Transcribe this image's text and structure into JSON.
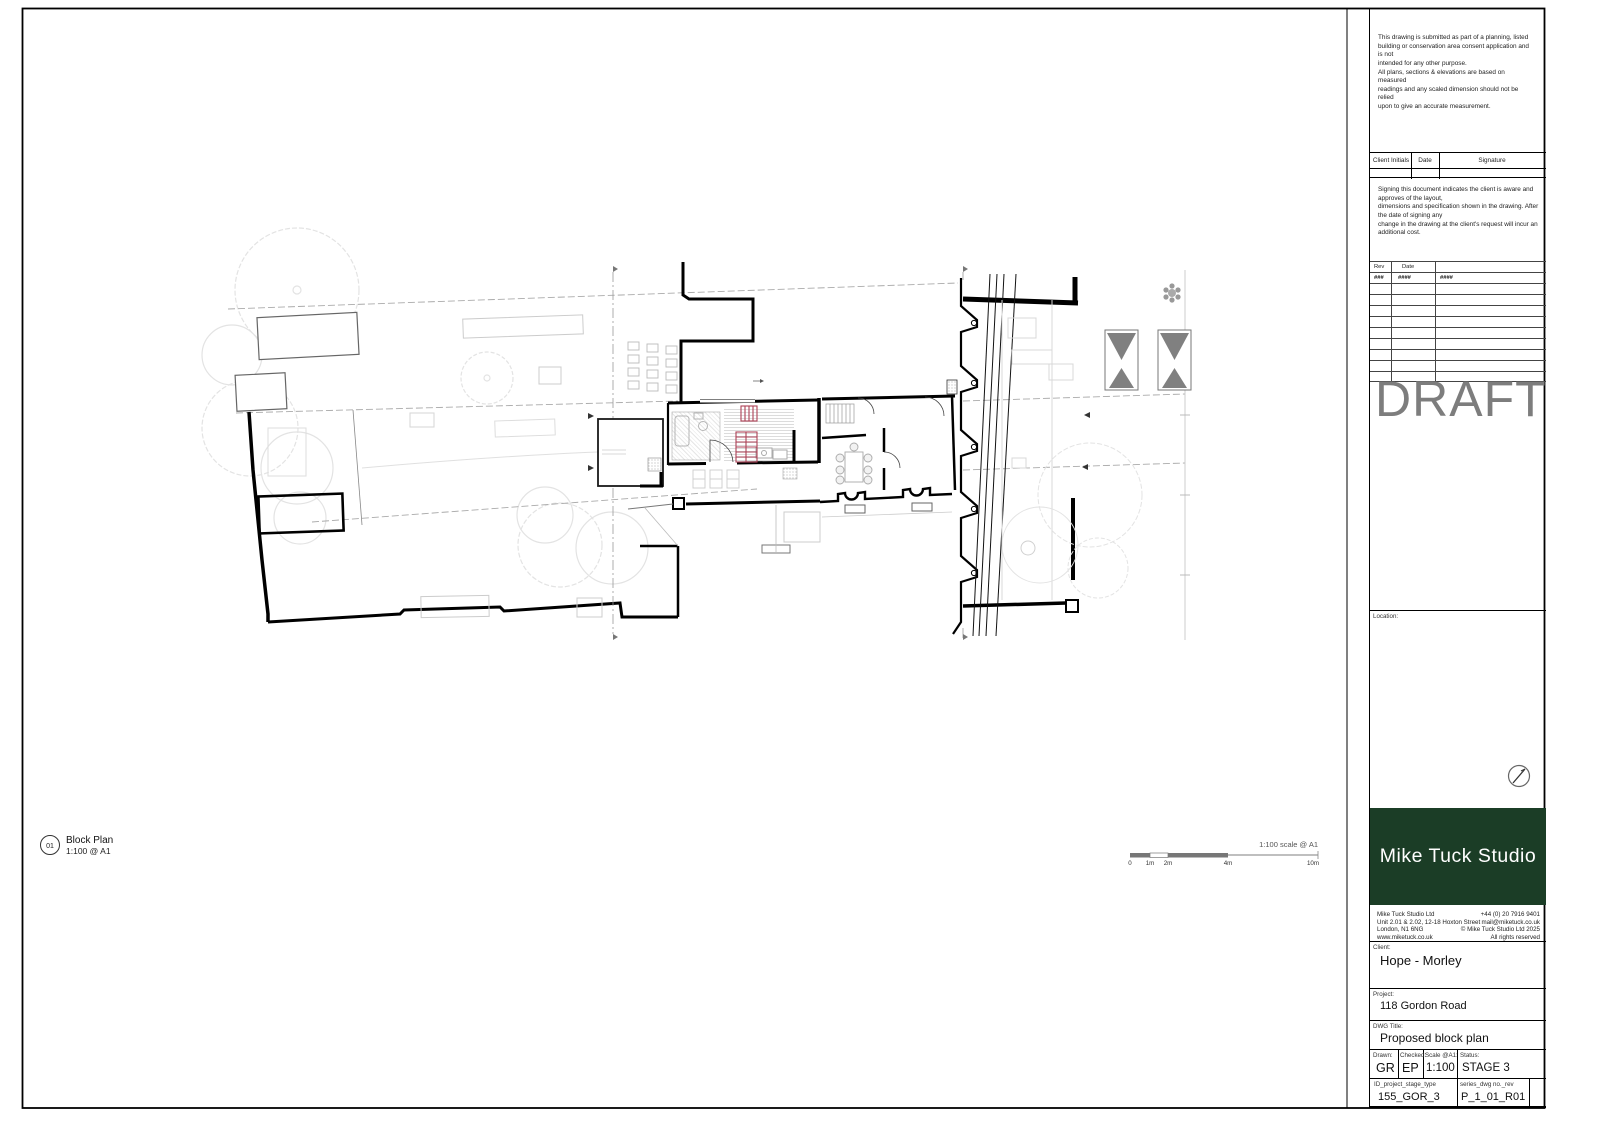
{
  "titleblock": {
    "disclaimer": "This drawing is submitted as part of a planning, listed\nbuilding or conservation area consent application and is not\nintended for any other purpose.\nAll plans, sections & elevations are based on measured\nreadings and any scaled dimension should not be relied\nupon to give an accurate measurement.",
    "sign_table": {
      "headers": [
        "Client Initials",
        "Date",
        "Signature"
      ]
    },
    "signing_note": "Signing this document indicates the client is aware and approves of the layout,\ndimensions and specification shown in the drawing. After the date of signing any\nchange in the drawing at the client's request will incur an additional cost.",
    "rev_table": {
      "headers": [
        "Rev",
        "Date"
      ],
      "first_row": {
        "rev": "###",
        "date": "####",
        "desc": "####"
      }
    },
    "draft": "DRAFT",
    "location_label": "Location:",
    "logo_text": "Mike Tuck Studio",
    "studio": {
      "address": "Mike Tuck Studio Ltd\nUnit 2.01 & 2.02, 12-18 Hoxton Street\nLondon, N1 6NG\nwww.miketuck.co.uk",
      "contact": "+44 (0) 20 7916 9401\nmail@miketuck.co.uk\n© Mike Tuck Studio Ltd 2025\nAll rights reserved"
    },
    "client": {
      "label": "Client:",
      "value": "Hope - Morley"
    },
    "project": {
      "label": "Project:",
      "value": "118 Gordon Road"
    },
    "dwg": {
      "label": "DWG Title:",
      "value": "Proposed block plan"
    },
    "meta": {
      "drawn_label": "Drawn:",
      "drawn": "GR",
      "checked_label": "Checked:",
      "checked": "EP",
      "scale_label": "Scale @A1:",
      "scale": "1:100",
      "status_label": "Status:",
      "status": "STAGE 3"
    },
    "ids": {
      "id_label": "ID_project_stage_type",
      "id_value": "155_GOR_3",
      "series_label": "series_dwg no._rev",
      "series_value": "P_1_01_R01"
    }
  },
  "plan_caption": {
    "number": "01",
    "title": "Block Plan",
    "scale": "1:100 @ A1"
  },
  "scale_bar": {
    "note": "1:100  scale @ A1",
    "tick0": "0",
    "tick1": "1m",
    "tick2": "2m",
    "tick4": "4m",
    "tick10": "10m"
  },
  "colors": {
    "logo_green": "#1b3d26",
    "draft_gray": "#7d7d7d",
    "stair_red": "#ac4257"
  }
}
